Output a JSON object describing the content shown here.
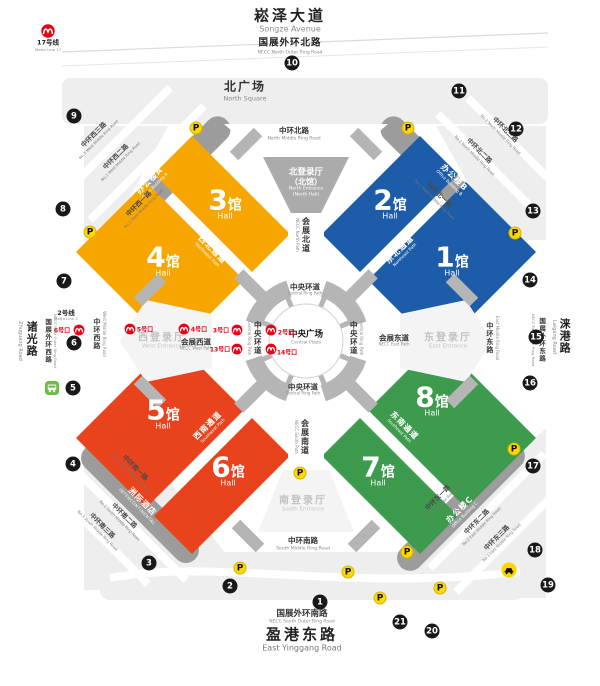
{
  "roads": {
    "songze": {
      "zh": "崧泽大道",
      "en": "Songze Avenue"
    },
    "north_outer": {
      "zh": "国展外环北路",
      "en": "NECC North Outer Ring Road"
    },
    "north_mid": {
      "zh": "中环北路",
      "en": "North Middle Ring Road"
    },
    "south_mid": {
      "zh": "中环南路",
      "en": "South Middle Ring Road"
    },
    "west_mid": {
      "zh": "中环西路",
      "en": "West Middle Ring Road"
    },
    "east_mid": {
      "zh": "中环东路",
      "en": "East Middle Ring Road"
    },
    "south_outer": {
      "zh": "国展外环南路",
      "en": "NECC South Outer Ring Road"
    },
    "yinggang": {
      "zh": "盈港东路",
      "en": "East Yinggang Road"
    },
    "zhuguang": {
      "zh": "诸光路",
      "en": "Zhuguang Road"
    },
    "west_outer": {
      "zh": "国展外环西路",
      "en": "NECC West Outer Ring Road"
    },
    "laigang": {
      "zh": "涞港路",
      "en": "Laigang Road"
    },
    "east_outer": {
      "zh": "国展外环东路",
      "en": "NECC East Outer Ring Road"
    },
    "west1": {
      "zh": "中环西一路",
      "en": "No.1 West Middle Ring Road"
    },
    "west2": {
      "zh": "中环西二路",
      "en": "No.2 West Middle Ring Road"
    },
    "west3": {
      "zh": "中环西三路",
      "en": "No.3 West Middle Ring Road"
    },
    "north1": {
      "zh": "中环北一路",
      "en": "No.1 North Middle Ring Road"
    },
    "north2": {
      "zh": "中环北二路",
      "en": "No.2 North Middle Ring Road"
    },
    "north3": {
      "zh": "中环北三路",
      "en": "No.3 North Middle Ring Road"
    },
    "south1": {
      "zh": "中环南一路",
      "en": "No.1 South Middle Ring Road"
    },
    "south2": {
      "zh": "中环南二路",
      "en": "No.2 South Middle Ring Road"
    },
    "south3": {
      "zh": "中环南三路",
      "en": "No.3 South Middle Ring Road"
    },
    "east1": {
      "zh": "中环东一路",
      "en": "No.1 East Middle Ring Road"
    },
    "east2": {
      "zh": "中环东二路",
      "en": "No.2 East Middle Ring Road"
    },
    "east3": {
      "zh": "中环东三路",
      "en": "No.3 East Middle Ring Road"
    }
  },
  "areas": {
    "north_square": {
      "zh": "北广场",
      "en": "North Square"
    },
    "plaza": {
      "zh": "中央广场",
      "en": "Central Plaza"
    }
  },
  "paths": {
    "ring": {
      "zh": "中央环道",
      "en": "Central Ring Path"
    },
    "necc_north": {
      "zh": "会展北道",
      "en": "NECC North Path"
    },
    "necc_south": {
      "zh": "会展南道",
      "en": "NECC South Path"
    },
    "necc_west": {
      "zh": "会展西道",
      "en": "NECC West Path"
    },
    "necc_east": {
      "zh": "会展东道",
      "en": "NECC East Path"
    },
    "nw": {
      "zh": "西北通道",
      "en": "Northwest Path"
    },
    "ne": {
      "zh": "东北通道",
      "en": "Northeast Path"
    },
    "sw": {
      "zh": "西南通道",
      "en": "Southwest Path"
    },
    "se": {
      "zh": "东南通道",
      "en": "Southeast Path"
    }
  },
  "entrances": {
    "north": {
      "zh": "北登录厅",
      "zh2": "（北馆）",
      "en": "North Entrance",
      "en2": "(North Hall)"
    },
    "west": {
      "zh": "西登录厅",
      "en": "West Entrance"
    },
    "east": {
      "zh": "东登录厅",
      "en": "East Entrance"
    },
    "south": {
      "zh": "南登录厅",
      "en": "South Entrance"
    }
  },
  "buildings": {
    "a": {
      "zh": "办公楼A",
      "en": "Office Building A"
    },
    "b": {
      "zh": "办公楼B",
      "en": "Office Building B"
    },
    "c": {
      "zh": "办公楼C",
      "en": "Office Building C"
    },
    "hotel": {
      "zh": "洲际酒店",
      "en": "INTERCONTINENTAL"
    }
  },
  "halls": [
    {
      "num": "1",
      "suffix": "馆",
      "en": "Hall"
    },
    {
      "num": "2",
      "suffix": "馆",
      "en": "Hall"
    },
    {
      "num": "3",
      "suffix": "馆",
      "en": "Hall"
    },
    {
      "num": "4",
      "suffix": "馆",
      "en": "Hall"
    },
    {
      "num": "5",
      "suffix": "馆",
      "en": "Hall"
    },
    {
      "num": "6",
      "suffix": "馆",
      "en": "Hall"
    },
    {
      "num": "7",
      "suffix": "馆",
      "en": "Hall"
    },
    {
      "num": "8",
      "suffix": "馆",
      "en": "Hall"
    }
  ],
  "metro": {
    "line17": {
      "zh": "17号线",
      "en": "Metro Line 17"
    },
    "line2": {
      "zh": "2号线",
      "en": "Metro Line 2"
    },
    "exit6": "6号口",
    "exit5": "5号口",
    "exit4": "4号口",
    "exit3": "3号口",
    "exit13": "13号口",
    "exit2": "2号口",
    "exit14": "14号口"
  },
  "gates": [
    "1",
    "2",
    "3",
    "4",
    "5",
    "6",
    "7",
    "8",
    "9",
    "10",
    "11",
    "12",
    "13",
    "14",
    "15",
    "16",
    "17",
    "18",
    "19",
    "20",
    "21"
  ],
  "icons": {
    "parking": "P"
  },
  "colors": {
    "hall_yellow": "#F7A600",
    "hall_blue": "#1D5CA8",
    "hall_red": "#E8431C",
    "hall_green": "#3E9B4E",
    "band_gray": "#9C9C9C",
    "patch_gray": "#EEEEEE",
    "ring_gray": "#B5B5B5",
    "entrance_gray": "#ABABAB",
    "metro_red": "#E60012",
    "parking_yellow": "#FFD900",
    "gate_black": "#191919",
    "bus_green": "#6CBE45"
  }
}
